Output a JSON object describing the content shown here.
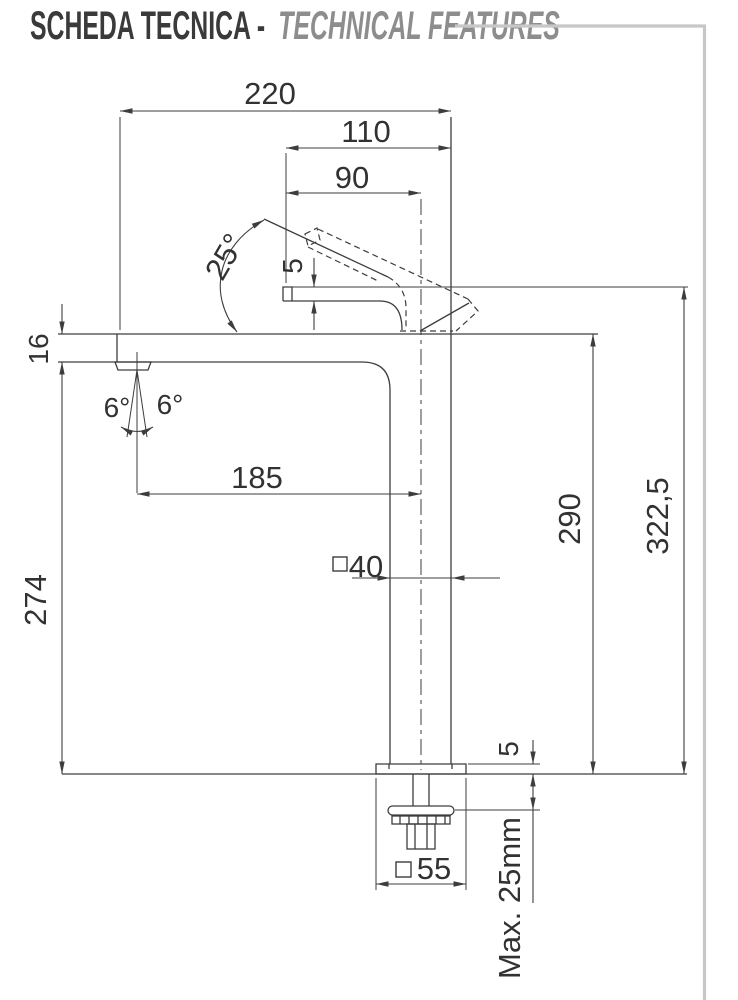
{
  "header": {
    "title_primary": "SCHEDA TECNICA -",
    "title_secondary": "TECHNICAL FEATURES"
  },
  "colors": {
    "background": "#ffffff",
    "drawing_line": "#3d3d3d",
    "dimension_text": "#323232",
    "frame_border": "#c7c7c7",
    "title_primary": "#3a3a3a",
    "title_secondary": "#8d8d8d"
  },
  "drawing": {
    "dimensions": {
      "total_depth": "220",
      "head_depth": "110",
      "spout_offset": "90",
      "lever_open_angle": "25°",
      "head_step_height": "5",
      "spout_front_height": "16",
      "spray_angle_left": "6°",
      "spray_angle_right": "6°",
      "spout_reach": "185",
      "body_section": {
        "symbol": "□",
        "value": "40"
      },
      "height_to_spout_bottom": "274",
      "height_to_spout_top": "290",
      "total_height": "322,5",
      "base_plate_thickness": "5",
      "base_section": {
        "symbol": "□",
        "value": "55"
      },
      "max_counter_thickness": "Max. 25mm"
    }
  }
}
